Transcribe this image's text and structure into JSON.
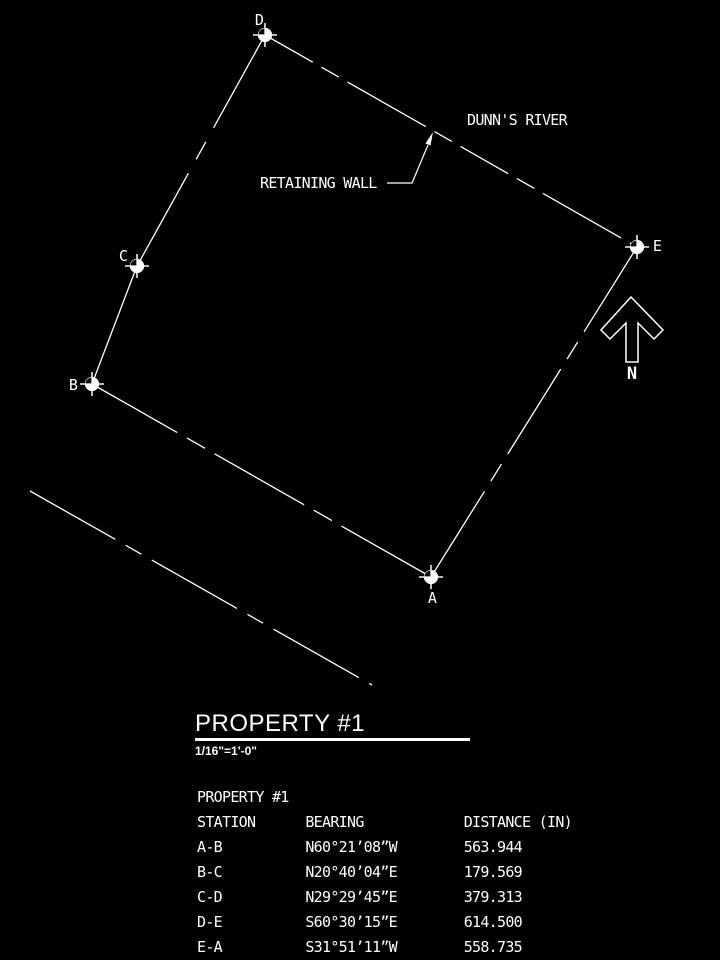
{
  "colors": {
    "background": "#000000",
    "ink": "#ffffff"
  },
  "drawing": {
    "point_labels": {
      "a": "A",
      "b": "B",
      "c": "C",
      "d": "D",
      "e": "E"
    },
    "annotations": {
      "river": "DUNN'S RIVER",
      "retaining_wall": "RETAINING WALL",
      "north": "N"
    }
  },
  "title_block": {
    "title": "PROPERTY #1",
    "scale": "1/16\"=1'-0\""
  },
  "table": {
    "title": "PROPERTY #1",
    "headers": {
      "station": "STATION",
      "bearing": "BEARING",
      "distance": "DISTANCE (IN)"
    },
    "rows": [
      {
        "station": "A-B",
        "bearing": "N60°21’08”W",
        "distance": "563.944"
      },
      {
        "station": "B-C",
        "bearing": "N20°40’04”E",
        "distance": "179.569"
      },
      {
        "station": "C-D",
        "bearing": "N29°29’45”E",
        "distance": "379.313"
      },
      {
        "station": "D-E",
        "bearing": "S60°30’15”E",
        "distance": "614.500"
      },
      {
        "station": "E-A",
        "bearing": "S31°51’11”W",
        "distance": "558.735"
      }
    ]
  }
}
